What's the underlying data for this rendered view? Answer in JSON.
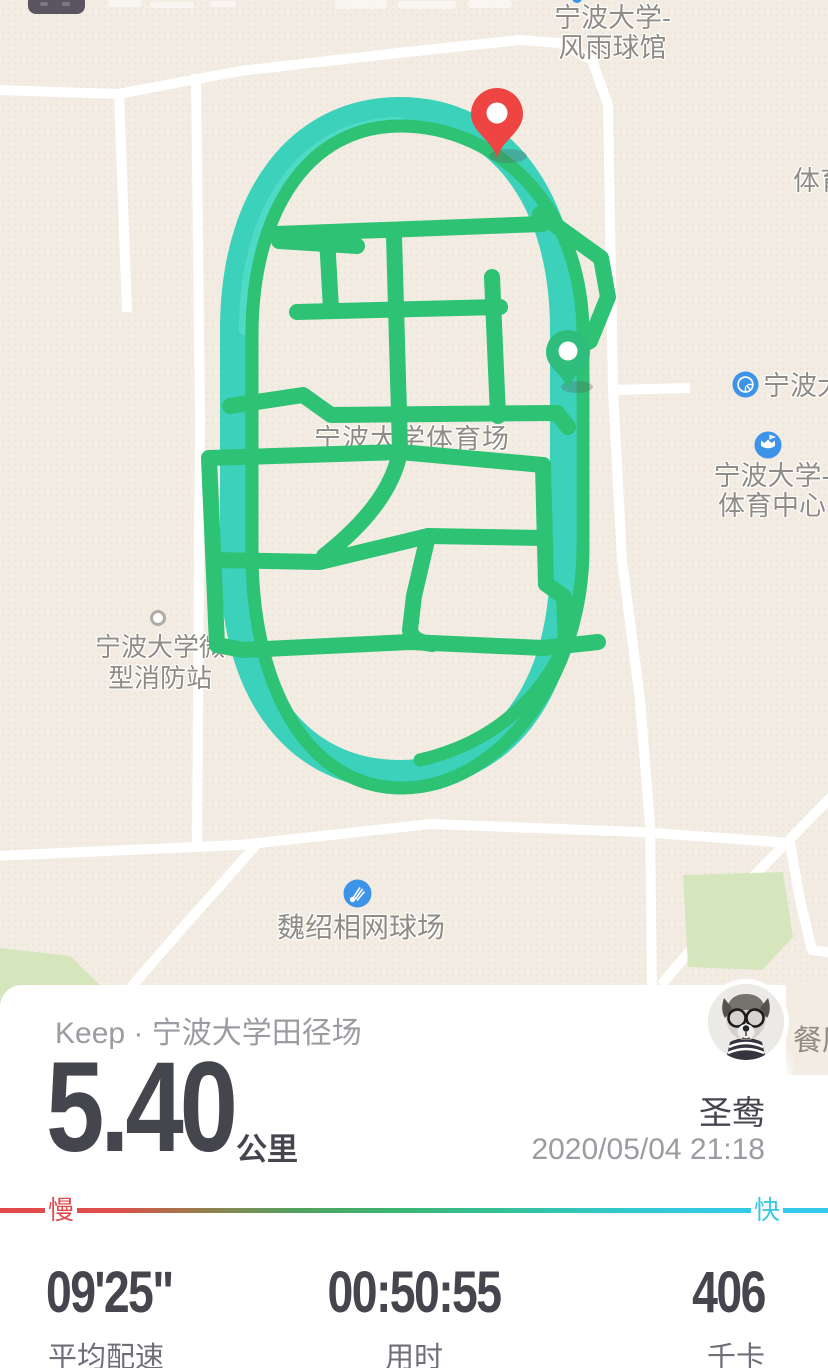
{
  "map": {
    "labels": {
      "gym_line1": "宁波大学-",
      "gym_line2": "风雨球馆",
      "tiyu": "体育",
      "nbd": "宁波大",
      "center_line1": "宁波大学-",
      "center_line2": "体育中心",
      "stadium": "宁波大学体育场",
      "fire_line1": "宁波大学微",
      "fire_line2": "型消防站",
      "tennis": "魏绍相网球场",
      "restaurant": "餐厅"
    },
    "colors": {
      "background": "#f2ece3",
      "road": "#ffffff",
      "park": "#d5e6bc",
      "poi_blue": "#3d93e8",
      "label_gray": "#8f8b85"
    }
  },
  "route": {
    "colors": {
      "track_teal": "#3bd1bb",
      "stroke_green": "#2ec274",
      "start_pin_green": "#2ebd7d",
      "finish_pin_red": "#ee4543"
    }
  },
  "card": {
    "title": "Keep · 宁波大学田径场",
    "distance": {
      "value": "5.40",
      "unit": "公里"
    },
    "user": {
      "name": "圣鸯",
      "datetime": "2020/05/04 21:18"
    },
    "pace_bar": {
      "slow": "慢",
      "fast": "快",
      "slow_color": "#e2494c",
      "fast_color": "#3cc9e3"
    },
    "stats": [
      {
        "value": "09'25\"",
        "label": "平均配速"
      },
      {
        "value": "00:50:55",
        "label": "用时"
      },
      {
        "value": "406",
        "label": "千卡"
      }
    ]
  }
}
